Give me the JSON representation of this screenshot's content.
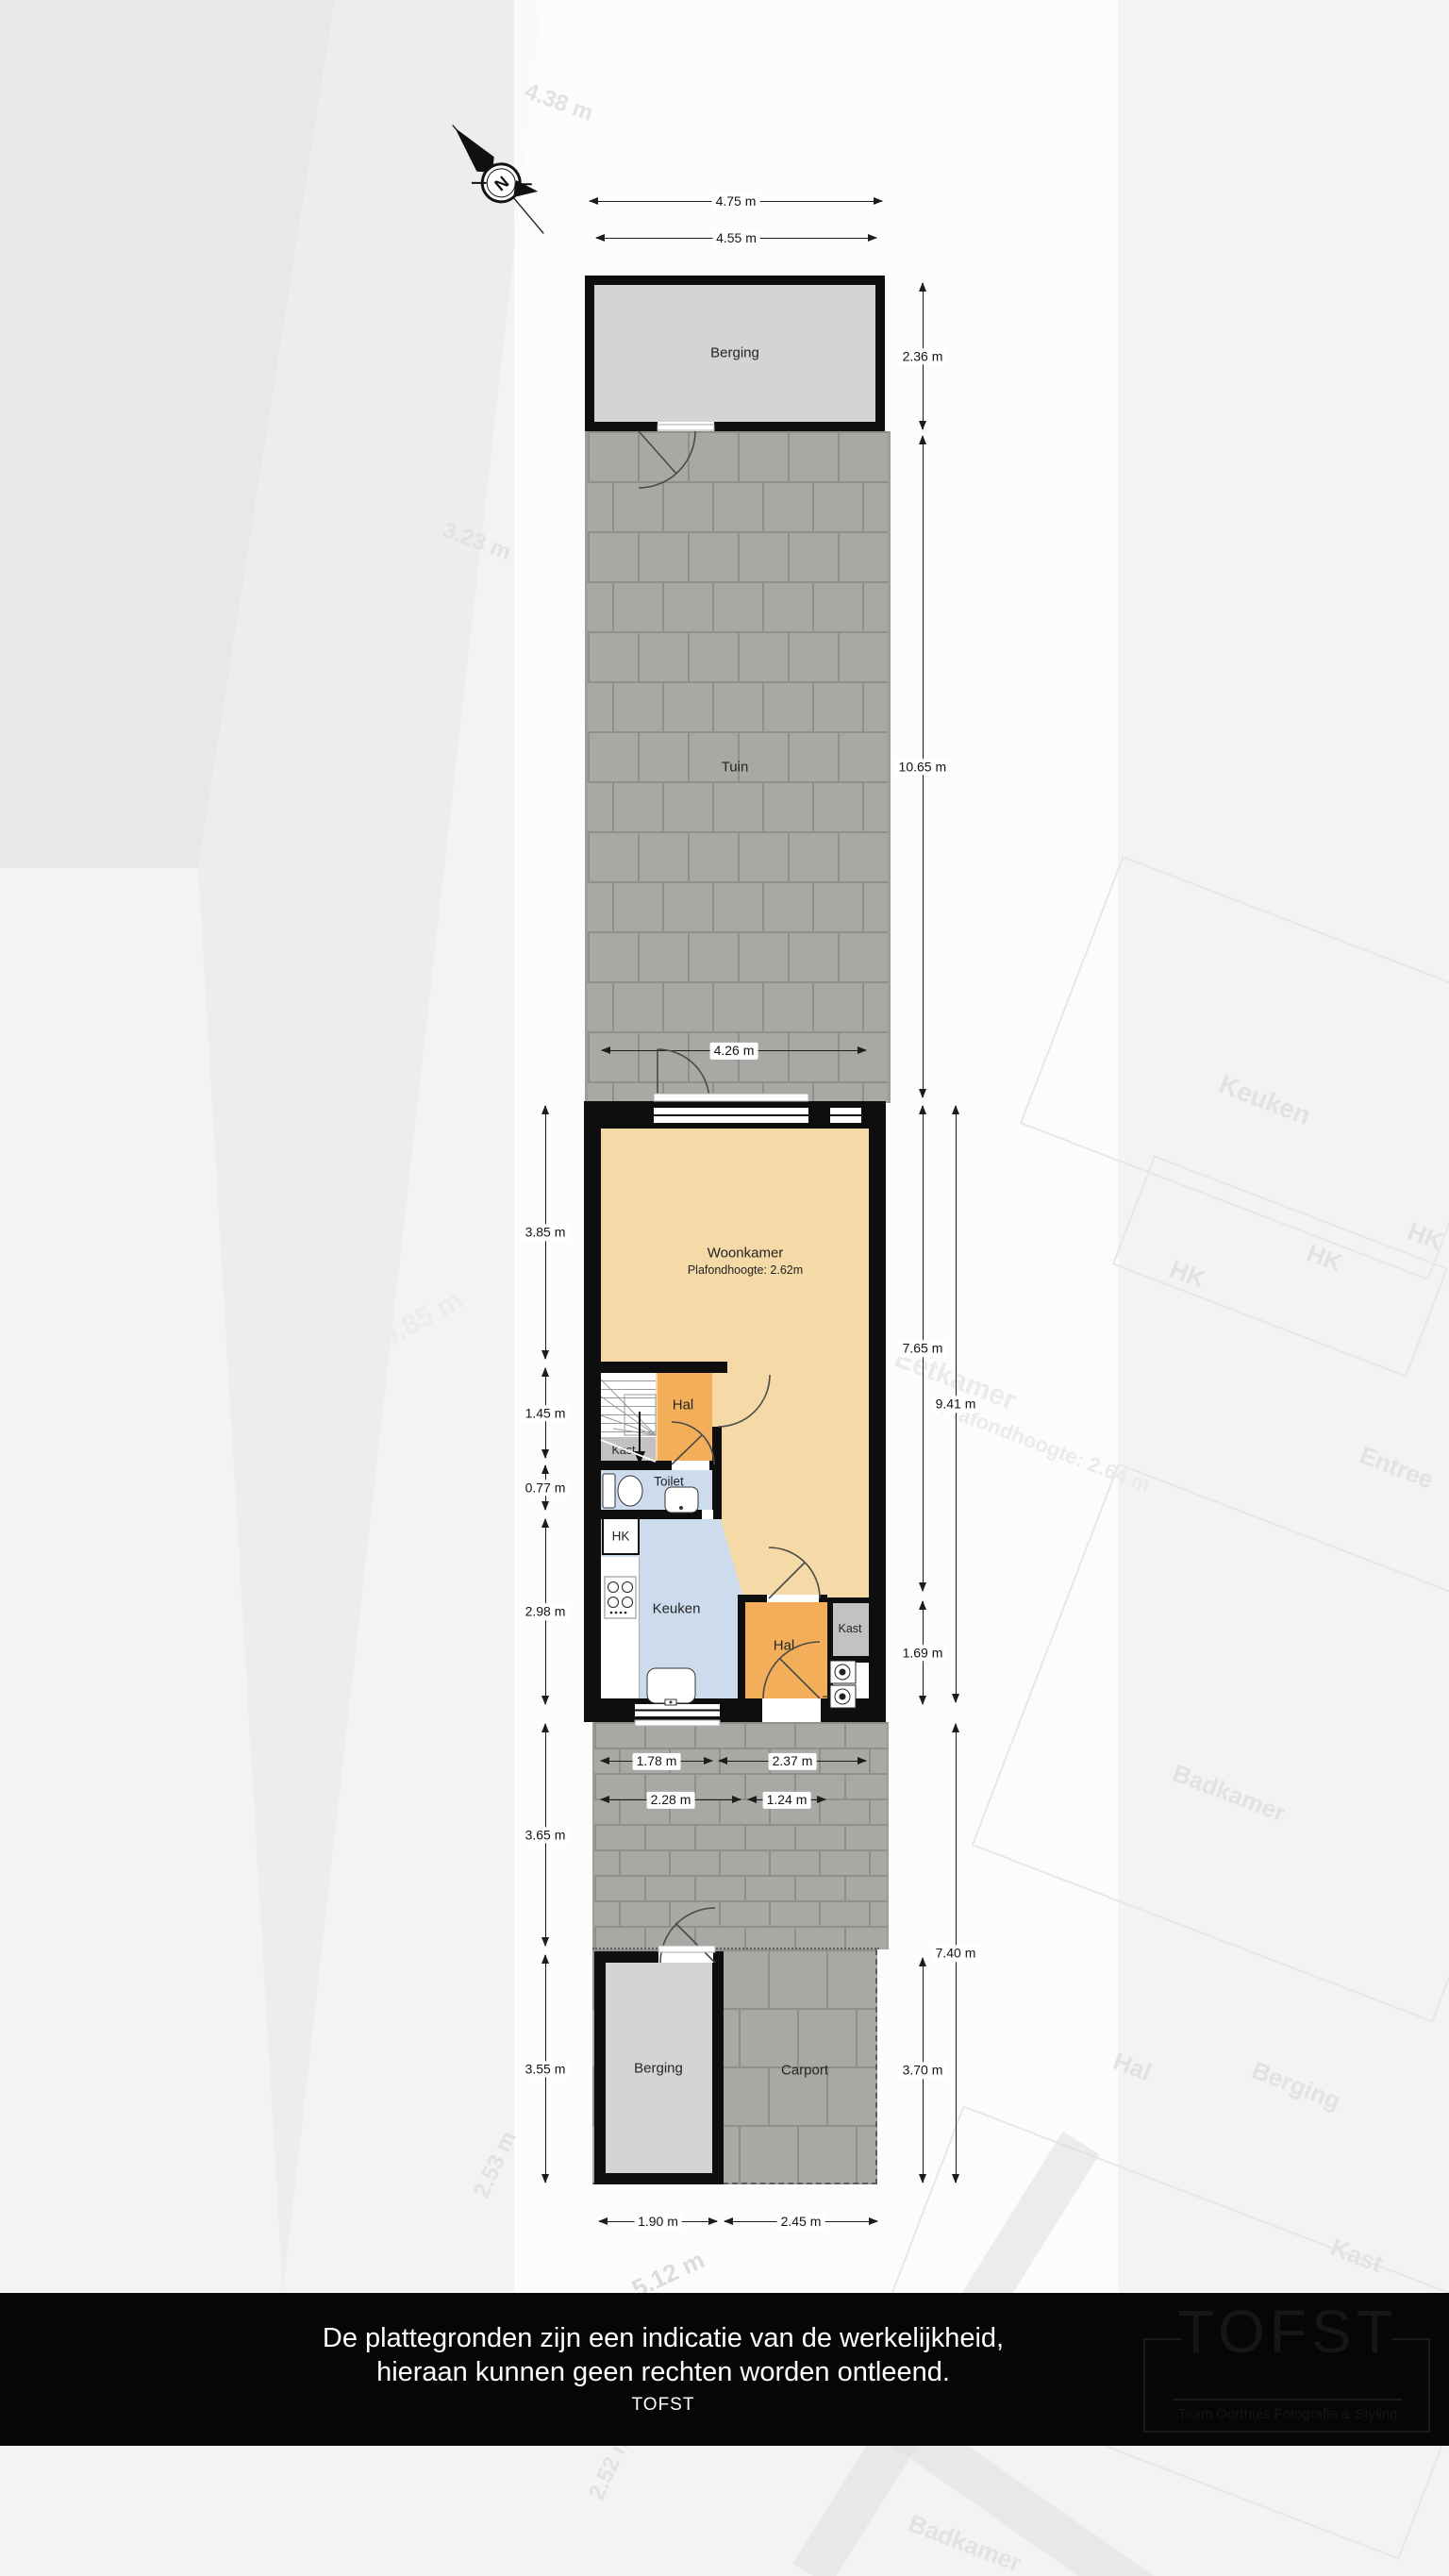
{
  "compass": {
    "north_label": "N"
  },
  "rooms": {
    "berging_top": "Berging",
    "tuin": "Tuin",
    "woonkamer": "Woonkamer",
    "woonkamer_ceiling": "Plafondhoogte: 2.62m",
    "hal_mid": "Hal",
    "kast_mid": "Kast",
    "toilet": "Toilet",
    "hk": "HK",
    "keuken": "Keuken",
    "hal_entry": "Hal",
    "kast_entry": "Kast",
    "berging_bottom": "Berging",
    "carport": "Carport"
  },
  "dims": {
    "top1": "4.75 m",
    "top2": "4.55 m",
    "berging_h": "2.36 m",
    "tuin_h": "10.65 m",
    "tuin_w": "4.26 m",
    "woonkamer_h": "3.85 m",
    "stairs_h": "1.45 m",
    "toilet_h": "0.77 m",
    "keuken_h": "2.98 m",
    "house_h1": "7.65 m",
    "house_h2": "9.41 m",
    "entry_h": "1.69 m",
    "front_w1": "1.78 m",
    "front_w2": "2.37 m",
    "front_w3": "2.28 m",
    "front_w4": "1.24 m",
    "drive_h": "3.65 m",
    "berging2_h": "3.55 m",
    "outside_h": "7.40 m",
    "carport_h": "3.70 m",
    "bottom_w1": "1.90 m",
    "bottom_w2": "2.45 m"
  },
  "footer": {
    "disclaimer_line1": "De plattegronden zijn een indicatie van de werkelijkheid,",
    "disclaimer_line2": "hieraan kunnen geen rechten worden ontleend.",
    "brand": "TOFST"
  },
  "logo": {
    "name": "TOFST",
    "tagline": "Team Oorthuis Fotografie & Styling"
  },
  "watermark": {
    "items": [
      {
        "t": "4.38 m"
      },
      {
        "t": "3.23 m"
      },
      {
        "t": "10.85 m"
      },
      {
        "t": "Keuken"
      },
      {
        "t": "HK"
      },
      {
        "t": "HK"
      },
      {
        "t": "HK"
      },
      {
        "t": "Eetkamer"
      },
      {
        "t": "Plafondhoogte: 2.64 m"
      },
      {
        "t": "Entree"
      },
      {
        "t": "Badkamer"
      },
      {
        "t": "Hal"
      },
      {
        "t": "Berging"
      },
      {
        "t": "Kast"
      },
      {
        "t": "2.53 m"
      },
      {
        "t": "5.12 m"
      },
      {
        "t": "2.52 m"
      },
      {
        "t": "Badkamer"
      }
    ]
  },
  "colors": {
    "wall": "#0e0e0e",
    "woonkamer": "#f5d9a7",
    "hal": "#f2ae59",
    "wet_rooms": "#cddcec",
    "storage": "#d4d4d4",
    "kast": "#c2c2c2",
    "paving": "#a8a9a4",
    "footer_bg": "#060606"
  }
}
